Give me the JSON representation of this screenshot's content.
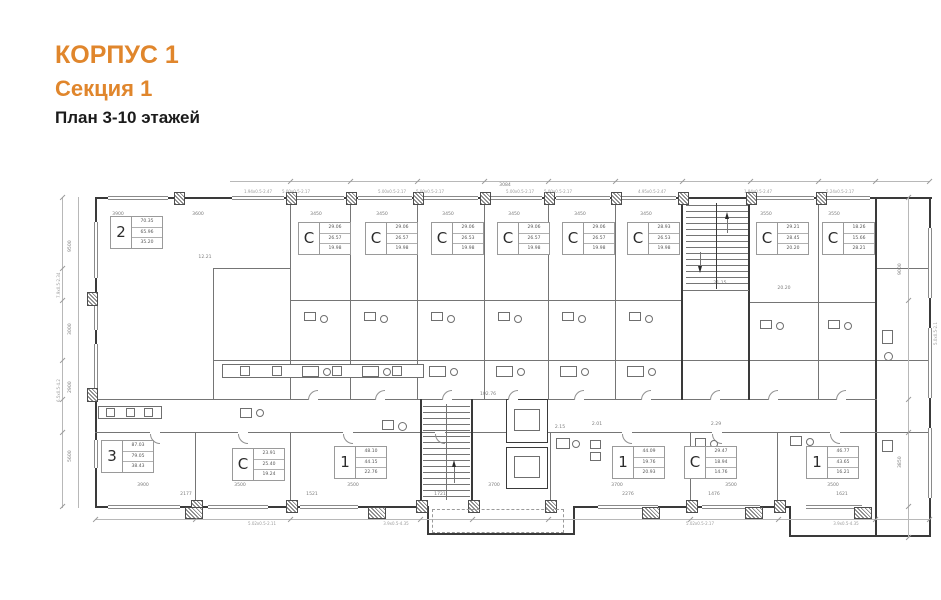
{
  "header": {
    "building": "КОРПУС 1",
    "section": "Секция 1",
    "plan": "План 3-10 этажей",
    "accent_color": "#e0862c"
  },
  "plan": {
    "apartments": [
      {
        "id": "apt-2",
        "type": "2",
        "values": [
          "70.35",
          "65.96",
          "35.20"
        ],
        "x": 110,
        "y": 216
      },
      {
        "id": "studio-1",
        "type": "С",
        "values": [
          "29.06",
          "26.57",
          "19.98"
        ],
        "x": 298,
        "y": 222
      },
      {
        "id": "studio-2",
        "type": "С",
        "values": [
          "29.06",
          "26.57",
          "19.98"
        ],
        "x": 365,
        "y": 222
      },
      {
        "id": "studio-3",
        "type": "С",
        "values": [
          "29.06",
          "26.53",
          "19.98"
        ],
        "x": 431,
        "y": 222
      },
      {
        "id": "studio-4",
        "type": "С",
        "values": [
          "29.06",
          "26.57",
          "19.98"
        ],
        "x": 497,
        "y": 222
      },
      {
        "id": "studio-5",
        "type": "С",
        "values": [
          "29.06",
          "26.57",
          "19.98"
        ],
        "x": 562,
        "y": 222
      },
      {
        "id": "studio-6",
        "type": "С",
        "values": [
          "28.93",
          "26.53",
          "19.98"
        ],
        "x": 627,
        "y": 222
      },
      {
        "id": "studio-7",
        "type": "С",
        "values": [
          "29.21",
          "28.45",
          "20.20"
        ],
        "x": 756,
        "y": 222
      },
      {
        "id": "studio-8",
        "type": "С",
        "values": [
          "18.26",
          "15.66",
          "28.21"
        ],
        "x": 822,
        "y": 222
      },
      {
        "id": "apt-3",
        "type": "3",
        "values": [
          "87.03",
          "79.05",
          "38.43"
        ],
        "x": 101,
        "y": 440
      },
      {
        "id": "studio-9",
        "type": "С",
        "values": [
          "23.91",
          "25.40",
          "19.24"
        ],
        "x": 232,
        "y": 448
      },
      {
        "id": "apt-1a",
        "type": "1",
        "values": [
          "48.10",
          "44.15",
          "22.76"
        ],
        "x": 334,
        "y": 446
      },
      {
        "id": "apt-1b",
        "type": "1",
        "values": [
          "44.09",
          "19.76",
          "20.93"
        ],
        "x": 612,
        "y": 446
      },
      {
        "id": "studio-10",
        "type": "С",
        "values": [
          "29.47",
          "18.94",
          "14.76"
        ],
        "x": 684,
        "y": 446
      },
      {
        "id": "apt-1c",
        "type": "1",
        "values": [
          "46.77",
          "43.65",
          "16.21"
        ],
        "x": 806,
        "y": 446
      }
    ],
    "dims_top": [
      {
        "t": "3900",
        "x": 118
      },
      {
        "t": "3600",
        "x": 198
      },
      {
        "t": "3450",
        "x": 316
      },
      {
        "t": "3450",
        "x": 382
      },
      {
        "t": "3450",
        "x": 448
      },
      {
        "t": "3450",
        "x": 514
      },
      {
        "t": "3450",
        "x": 580
      },
      {
        "t": "3450",
        "x": 646
      },
      {
        "t": "3550",
        "x": 766
      },
      {
        "t": "3550",
        "x": 834
      }
    ],
    "dims_bottom": [
      {
        "t": "3900",
        "x": 143
      },
      {
        "t": "3500",
        "x": 240
      },
      {
        "t": "3500",
        "x": 353
      },
      {
        "t": "3700",
        "x": 494
      },
      {
        "t": "3700",
        "x": 617
      },
      {
        "t": "3500",
        "x": 731
      },
      {
        "t": "3500",
        "x": 833
      }
    ],
    "dims_small_bottom": [
      {
        "t": "2177",
        "x": 186
      },
      {
        "t": "1521",
        "x": 312
      },
      {
        "t": "1721",
        "x": 440
      },
      {
        "t": "2276",
        "x": 628
      },
      {
        "t": "1476",
        "x": 714
      },
      {
        "t": "1621",
        "x": 842
      }
    ],
    "dims_left": [
      {
        "t": "9500",
        "y": 252
      },
      {
        "t": "3000",
        "y": 335
      },
      {
        "t": "2900",
        "y": 393
      },
      {
        "t": "5600",
        "y": 462
      }
    ],
    "dims_right": [
      {
        "t": "9000",
        "y": 275
      },
      {
        "t": "3850",
        "y": 468
      }
    ],
    "window_labels_top": [
      {
        "t": "1.94х0.5-2.47",
        "x": 258
      },
      {
        "t": "5.00х0.5-2.17",
        "x": 296
      },
      {
        "t": "5.00х0.5-2.17",
        "x": 392
      },
      {
        "t": "5.00х0.5-2.17",
        "x": 430
      },
      {
        "t": "5.00х0.5-2.17",
        "x": 520
      },
      {
        "t": "5.00х0.5-2.17",
        "x": 558
      },
      {
        "t": "4.95х0.5-2.47",
        "x": 652
      },
      {
        "t": "1.94х0.5-2.47",
        "x": 758
      },
      {
        "t": "5.24х0.5-2.17",
        "x": 840
      }
    ],
    "window_labels_bottom": [
      {
        "t": "5.02х0.5-2.11",
        "x": 262
      },
      {
        "t": "3.9х0.5-4.35",
        "x": 396
      },
      {
        "t": "5.02х0.5-2.17",
        "x": 700
      },
      {
        "t": "3.9х0.5-4.35",
        "x": 846
      }
    ],
    "window_labels_left": [
      {
        "t": "7.9х0.5-2.34",
        "y": 298
      },
      {
        "t": "6.5х0.5-4.2",
        "y": 402
      }
    ],
    "window_labels_right": [
      {
        "t": "5.0х0.5-2.1",
        "y": 345
      }
    ],
    "room_dims": [
      {
        "t": "12.21",
        "x": 205,
        "y": 255
      },
      {
        "t": "20.20",
        "x": 784,
        "y": 286
      },
      {
        "t": "102.76",
        "x": 488,
        "y": 392
      },
      {
        "t": "21.15",
        "x": 720,
        "y": 281
      },
      {
        "t": "2.01",
        "x": 597,
        "y": 422
      },
      {
        "t": "2.29",
        "x": 716,
        "y": 422
      },
      {
        "t": "2.15",
        "x": 560,
        "y": 425
      },
      {
        "t": "3084",
        "x": 505,
        "y": 183
      }
    ]
  }
}
